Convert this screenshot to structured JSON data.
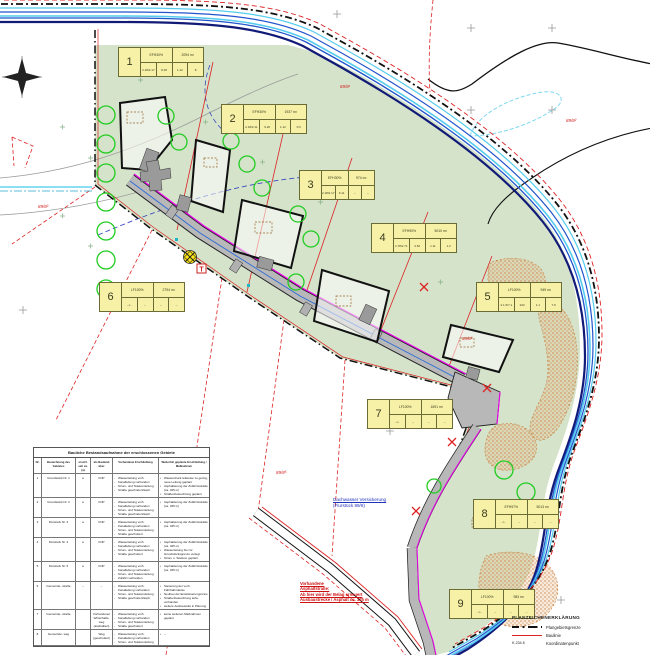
{
  "colors": {
    "site_green": "#cfe0c4",
    "stream_cyan": "#55ccee",
    "stream_blue": "#2255cc",
    "stream_navy": "#111a77",
    "road_gray": "#b8b8b8",
    "magenta": "#ee00ee",
    "red": "#dd2222",
    "label_yellow": "#f6f1a6",
    "tree_green": "#22cc22",
    "stipple_orange": "#c06a28"
  },
  "lots": [
    {
      "num": "1",
      "usage": "EFH30%",
      "area": "2094 m²",
      "row2": [
        "2.18/2.17",
        "8.20",
        "1.12",
        "8"
      ],
      "x": 118,
      "y": 47,
      "w": 86
    },
    {
      "num": "2",
      "usage": "EFH30%",
      "area": "1937 m²",
      "row2": [
        "2.18/2.11",
        "9.20",
        "1.12",
        "P.3"
      ],
      "x": 221,
      "y": 104,
      "w": 86
    },
    {
      "num": "3",
      "usage": "EFH30%",
      "area": "974 m²",
      "row2": [
        "2.18/2.17",
        "9.11",
        "–",
        "–"
      ],
      "x": 299,
      "y": 170,
      "w": 76
    },
    {
      "num": "4",
      "usage": "EFH90%",
      "area": "5010 m²",
      "row2": [
        "2.78/2.71",
        "4.52",
        "1.11",
        "1.2"
      ],
      "x": 371,
      "y": 223,
      "w": 86
    },
    {
      "num": "5",
      "usage": "LF100%",
      "area": "949 m²",
      "row2": [
        "2.1.5/7.1",
        "232",
        "1.1",
        "7.9"
      ],
      "x": 476,
      "y": 282,
      "w": 86
    },
    {
      "num": "6",
      "usage": "LF100%",
      "area": "2794 m²",
      "row2": [
        "–/–",
        "–",
        "–",
        "–"
      ],
      "x": 99,
      "y": 282,
      "w": 86
    },
    {
      "num": "7",
      "usage": "LF100%",
      "area": "1691 m²",
      "row2": [
        "–/–",
        "–",
        "–",
        "–"
      ],
      "x": 367,
      "y": 399,
      "w": 86
    },
    {
      "num": "8",
      "usage": "EFH97%",
      "area": "5013 m²",
      "row2": [
        "–/–",
        "–",
        "–",
        "–"
      ],
      "x": 473,
      "y": 499,
      "w": 86
    },
    {
      "num": "9",
      "usage": "LF100%",
      "area": "983 m²",
      "row2": [
        "–/–",
        "–",
        "–",
        "–"
      ],
      "x": 449,
      "y": 589,
      "w": 86
    }
  ],
  "parcel_labels": [
    {
      "text": "89/8¹",
      "x": 340,
      "y": 88
    },
    {
      "text": "89/8²",
      "x": 566,
      "y": 122
    },
    {
      "text": "89/8³",
      "x": 38,
      "y": 208
    },
    {
      "text": "89/8⁴",
      "x": 128,
      "y": 620
    },
    {
      "text": "89/8⁵",
      "x": 276,
      "y": 474
    },
    {
      "text": "89/8⁶",
      "x": 462,
      "y": 340
    }
  ],
  "annotations": {
    "infiltration": {
      "line1": "Dachwasser Versickerung",
      "line2": "(Flurstück 89/8)"
    },
    "road_note": {
      "line1": "Vorhandene",
      "line2": "Asphaltstraße:",
      "line3": "Ab hier wird der Belag erneuert",
      "line4": "Ausbaustrecke / Asphalt ca. 325 m"
    },
    "t_symbol": "T"
  },
  "info_table": {
    "title": "Bauliche Bestandsaufnahme der erschlossenen Gebiete",
    "headers": [
      "Nr.",
      "Bezeichnung des Gebietes",
      "erschl. seit ca. (a)",
      "als Bauland über",
      "Vorhandene Erschließung",
      "Weiterhin geplante Erschließung / Maßnahmen"
    ],
    "rows": [
      {
        "no": "1",
        "name": "Grundstück Nr. 1",
        "age": "a",
        "status": "FNP",
        "exist": [
          "Wasserleitung vorh.",
          "Kanalleitung vorhanden",
          "Strom- und Telekomleitung",
          "Straße geschottert/asph."
        ],
        "planned": [
          "Wasserdruck teilweise zu gering, neue Leitung geplant",
          "Asphaltierung der Zufahrtsstraße (ca. 325 m)",
          "Straßenbeleuchtung geplant"
        ]
      },
      {
        "no": "2",
        "name": "Grundstück Nr. 2",
        "age": "a",
        "status": "FNP",
        "exist": [
          "Wasserleitung vorh.",
          "Kanalleitung vorhanden",
          "Strom- und Telekomleitung",
          "Straße geschottert/asph."
        ],
        "planned": [
          "Asphaltierung der Zufahrtsstraße (ca. 325 m)"
        ]
      },
      {
        "no": "3",
        "name": "Flurstück Nr. 3",
        "age": "a",
        "status": "FNP",
        "exist": [
          "Wasserleitung vorh.",
          "Kanalleitung vorhanden",
          "Strom- und Telekomleitung",
          "Straße geschottert"
        ],
        "planned": [
          "Asphaltierung der Zufahrtsstraße (ca. 325 m)"
        ]
      },
      {
        "no": "4",
        "name": "Flurstück Nr. 4",
        "age": "a",
        "status": "FNP",
        "exist": [
          "Wasserleitung vorh.",
          "Kanalleitung vorhanden",
          "Strom- und Telekomleitung",
          "Straße geschottert"
        ],
        "planned": [
          "Asphaltierung der Zufahrtsstraße (ca. 325 m)",
          "Wasserleitung bis zur Grundstücksgrenze verlegt",
          "Strom u. Telekom geplant"
        ]
      },
      {
        "no": "5",
        "name": "Flurstück Nr. 5",
        "age": "a",
        "status": "FNP",
        "exist": [
          "Wasserleitung vorh.",
          "Kanalleitung vorhanden",
          "Strom- und Telekomleitung",
          "Zufahrt vorhanden"
        ],
        "planned": [
          "Asphaltierung der Zufahrtsstraße (ca. 325 m)"
        ]
      },
      {
        "no": "6",
        "name": "Gemeinde- straße",
        "age": "–",
        "status": "–",
        "exist": [
          "Wasserleitung vorh.",
          "Kanalleitung vorhanden",
          "Strom- und Telekomleitung",
          "Straße geschottert/asph."
        ],
        "planned": [
          "Sanierung der vorh. Fahrbahndecke",
          "Neubau der Entwässerungsrinne",
          "Straßenbeleuchtung teilw. vorhanden",
          "weitere Ausbaustufe in Planung"
        ]
      },
      {
        "no": "7",
        "name": "Gemeinde- straße",
        "age": "",
        "status": "Vorhandener Wirtschafts- weg (asphaltiert)",
        "exist": [
          "Wasserleitung vorh.",
          "Kanalleitung vorhanden",
          "Strom- und Telekomleitung",
          "Straße geschottert"
        ],
        "planned": [
          "keine weiteren Maßnahmen geplant"
        ]
      },
      {
        "no": "8",
        "name": "Gemeinde- weg",
        "age": "",
        "status": "Weg (geschottert)",
        "exist": [
          "Wasserleitung vorh.",
          "Kanalleitung vorhanden",
          "Strom- und Telekomleitung"
        ],
        "planned": [
          "–"
        ]
      }
    ]
  },
  "legend": {
    "title": "PLANZEICHENERKLÄRUNG",
    "items": [
      {
        "type": "dashdot",
        "sample_text": "",
        "label": "Plangebietsgrenze"
      },
      {
        "type": "redline",
        "sample_text": "",
        "label": "Baulinie"
      },
      {
        "type": "text",
        "sample_text": "K-234  8",
        "label": "Koordinatenpunkt"
      }
    ]
  }
}
